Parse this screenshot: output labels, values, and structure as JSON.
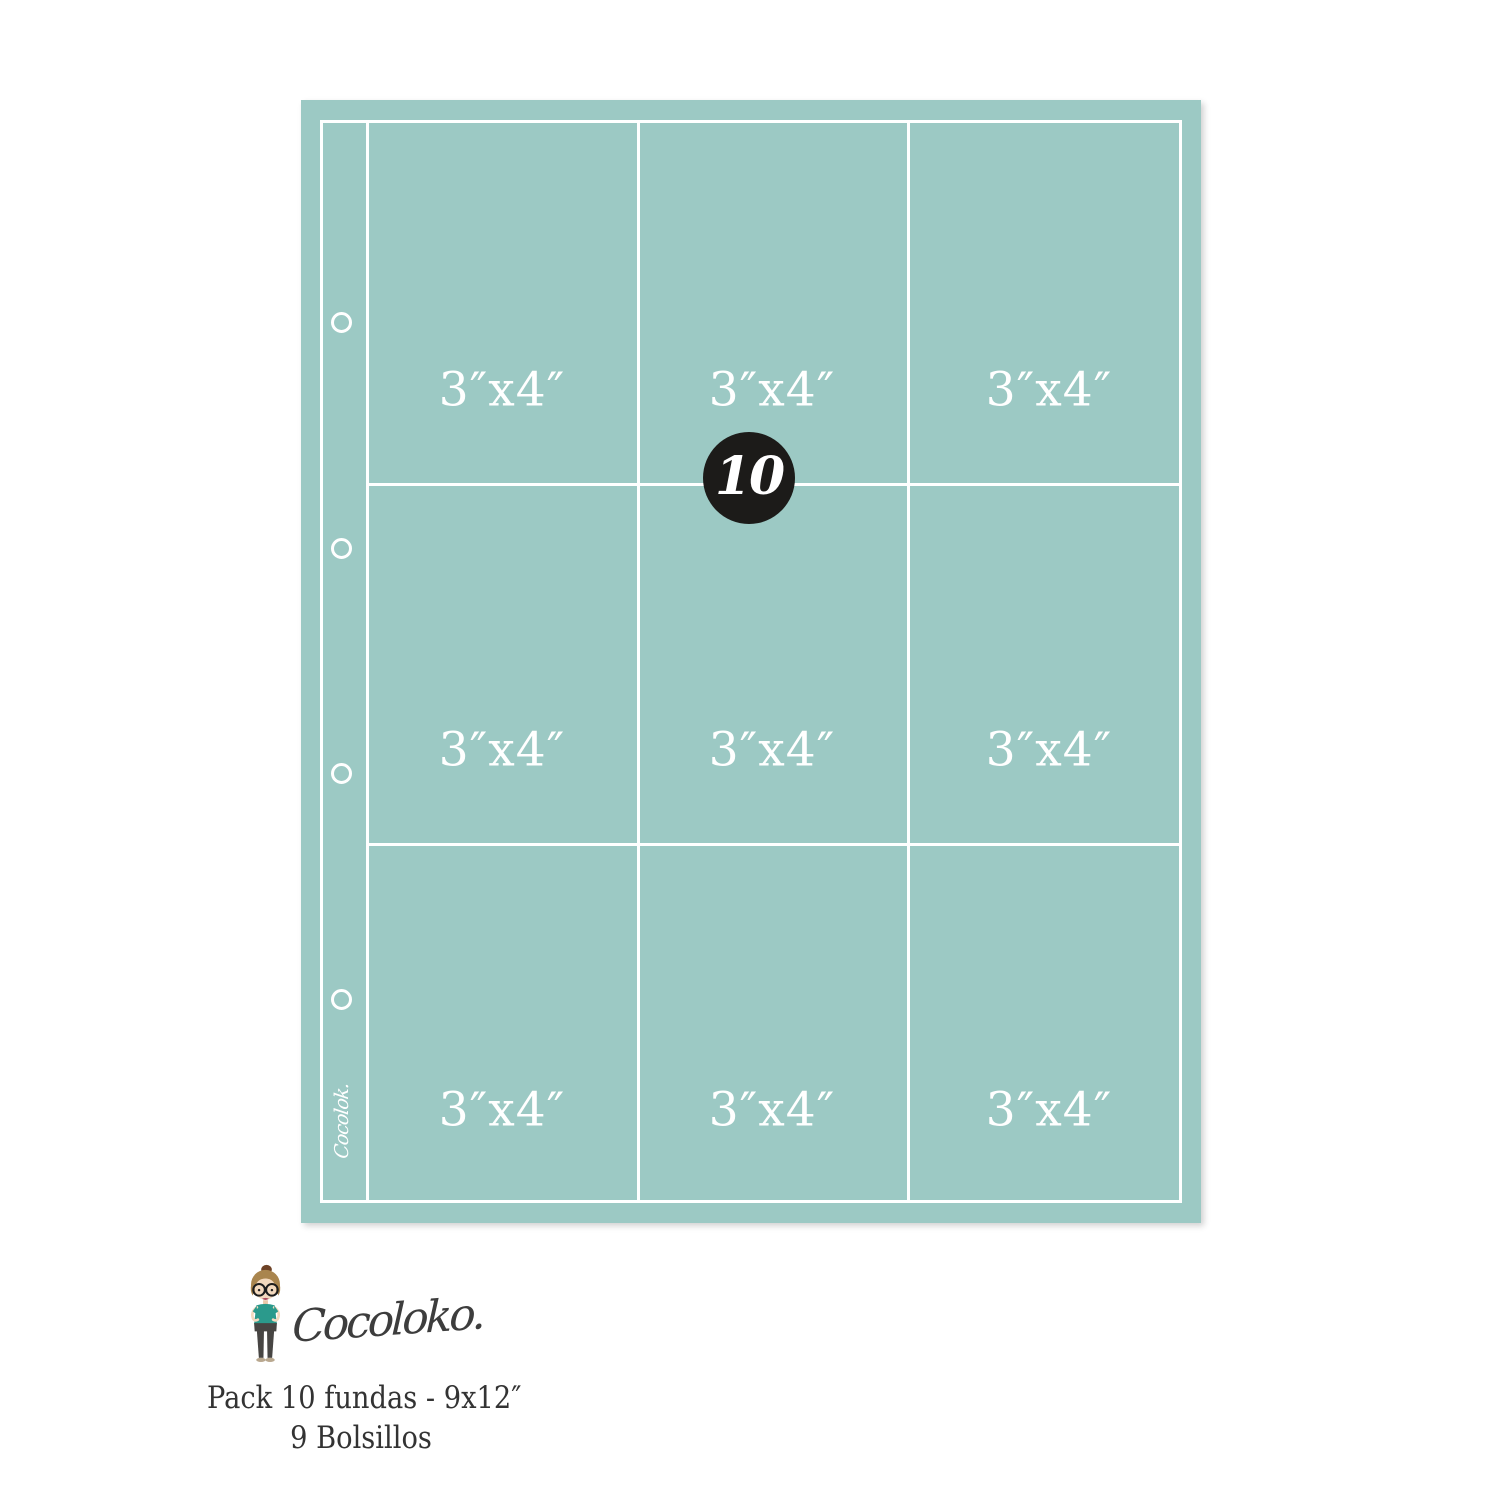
{
  "sheet": {
    "pocket_labels": [
      "3″x4″",
      "3″x4″",
      "3″x4″",
      "3″x4″",
      "3″x4″",
      "3″x4″",
      "3″x4″",
      "3″x4″",
      " 3″x4″"
    ],
    "badge_count": "10",
    "spine_script": "Cocolok."
  },
  "branding": {
    "logo_script": "Cocoloko.",
    "tagline_line1": "Pack 10 fundas - 9x12″",
    "tagline_line2": "9 Bolsillos"
  },
  "icons": {
    "mascot": "girl-with-bun-and-round-glasses"
  },
  "colors": {
    "sheet_teal": "#9cc9c4",
    "grid_line_white": "#ffffff",
    "badge_black": "#1c1b19",
    "logo_script_gray": "#3d3d3d",
    "tagline_gray": "#333333",
    "mascot_shirt_teal": "#2b9a8c",
    "mascot_hair_brown": "#a9854e"
  }
}
